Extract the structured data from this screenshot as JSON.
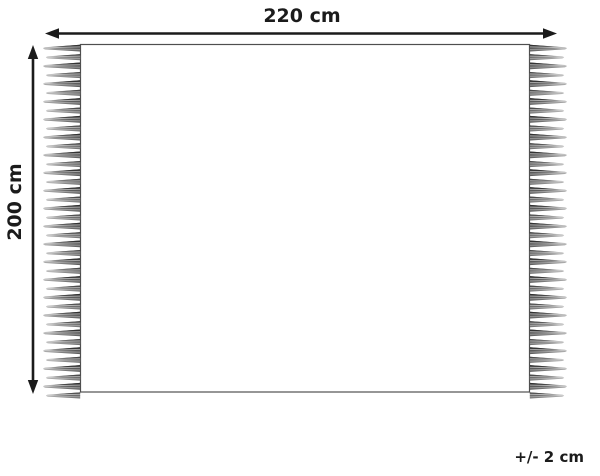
{
  "diagram": {
    "kind": "product-dimension-diagram",
    "item": "rectangular rug with fringe tassels on left and right edges"
  },
  "labels": {
    "width": "220 cm",
    "height": "200 cm",
    "tolerance": "+/- 2 cm"
  },
  "dimensions": {
    "width_cm": 220,
    "height_cm": 200,
    "tolerance_cm": 2
  },
  "fringe": {
    "tassels_per_side": 40,
    "sides": [
      "left",
      "right"
    ]
  },
  "colors": {
    "background": "#ffffff",
    "arrow": "#1b1b1b",
    "outline": "#4f4f4f",
    "tassel_dark": "#2f2f2f",
    "tassel_mid": "#9c9c9c",
    "tassel_light": "#cfcfcf"
  }
}
